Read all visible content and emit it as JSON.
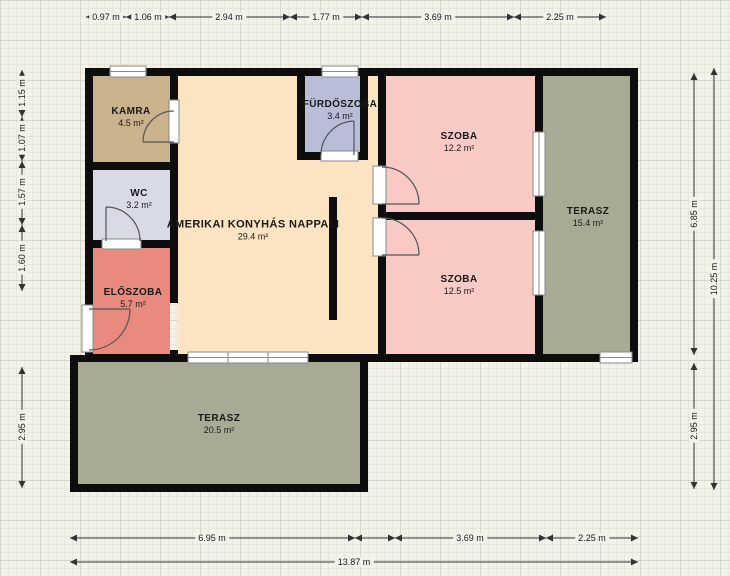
{
  "colors": {
    "bg": "#f2f1ea",
    "grid_minor": "#e7e6db",
    "grid_major": "#d7d6ca",
    "wall": "#0d0d0d",
    "dim": "#333333",
    "door": "#555555",
    "window_frame": "#8a8a8a",
    "window_fill": "#ffffff",
    "text": "#1a1a1a"
  },
  "rooms": [
    {
      "id": "kamra",
      "name": "KAMRA",
      "area": "4.5 m²",
      "color": "#c9b28c"
    },
    {
      "id": "wc",
      "name": "WC",
      "area": "3.2 m²",
      "color": "#d8dae6"
    },
    {
      "id": "eloszoba",
      "name": "ELŐSZOBA",
      "area": "5.7 m²",
      "color": "#e88a7d"
    },
    {
      "id": "nappali",
      "name": "AMERIKAI KONYHÁS NAPPALI",
      "area": "29.4 m²",
      "color": "#fce3c1"
    },
    {
      "id": "furdoszoba",
      "name": "FÜRDŐSZOBA",
      "area": "3.4 m²",
      "color": "#b9bdd8"
    },
    {
      "id": "szoba-felso",
      "name": "SZOBA",
      "area": "12.2 m²",
      "color": "#f8c9c5"
    },
    {
      "id": "szoba-also",
      "name": "SZOBA",
      "area": "12.5 m²",
      "color": "#f8c9c5"
    },
    {
      "id": "terasz-jobb",
      "name": "TERASZ",
      "area": "15.4 m²",
      "color": "#a8aa95"
    },
    {
      "id": "terasz-also",
      "name": "TERASZ",
      "area": "20.5 m²",
      "color": "#a8aa95"
    }
  ],
  "dimensions": {
    "top": [
      "0.97 m",
      "1.06 m",
      "2.94 m",
      "1.77 m",
      "3.69 m",
      "2.25 m"
    ],
    "left": [
      "1.15 m",
      "1.07 m",
      "1.57 m",
      "1.60 m",
      "2.95 m"
    ],
    "right": [
      "6.85 m",
      "2.95 m"
    ],
    "right_total": "10.25 m",
    "bottom": [
      "6.95 m",
      "3.69 m",
      "2.25 m"
    ],
    "bottom_total": "13.87 m"
  }
}
